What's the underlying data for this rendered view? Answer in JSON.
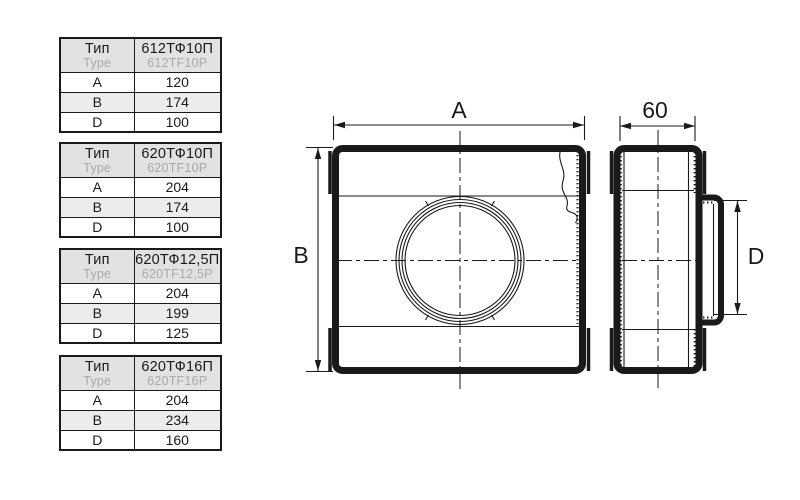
{
  "page": {
    "background": "#ffffff"
  },
  "colors": {
    "line": "#1a1a1a",
    "secondary_text": "#aaaaaa",
    "header_bg": "#e2e2e2",
    "alt_row_bg": "#ececec"
  },
  "tables": [
    {
      "type_label_ru": "Тип",
      "type_label_en": "Type",
      "code_ru": "612ТФ10П",
      "code_en": "612TF10P",
      "rows": [
        {
          "param": "A",
          "value": "120"
        },
        {
          "param": "B",
          "value": "174"
        },
        {
          "param": "D",
          "value": "100"
        }
      ]
    },
    {
      "type_label_ru": "Тип",
      "type_label_en": "Type",
      "code_ru": "620ТФ10П",
      "code_en": "620TF10P",
      "rows": [
        {
          "param": "A",
          "value": "204"
        },
        {
          "param": "B",
          "value": "174"
        },
        {
          "param": "D",
          "value": "100"
        }
      ]
    },
    {
      "type_label_ru": "Тип",
      "type_label_en": "Type",
      "code_ru": "620ТФ12,5П",
      "code_en": "620TF12,5P",
      "rows": [
        {
          "param": "A",
          "value": "204"
        },
        {
          "param": "B",
          "value": "199"
        },
        {
          "param": "D",
          "value": "125"
        }
      ]
    },
    {
      "type_label_ru": "Тип",
      "type_label_en": "Type",
      "code_ru": "620ТФ16П",
      "code_en": "620TF16P",
      "rows": [
        {
          "param": "A",
          "value": "204"
        },
        {
          "param": "B",
          "value": "234"
        },
        {
          "param": "D",
          "value": "160"
        }
      ]
    }
  ],
  "drawing": {
    "front_view": {
      "dim_width_label": "A",
      "dim_height_label": "B"
    },
    "side_view": {
      "dim_depth_label": "60",
      "dim_diameter_label": "D"
    }
  }
}
